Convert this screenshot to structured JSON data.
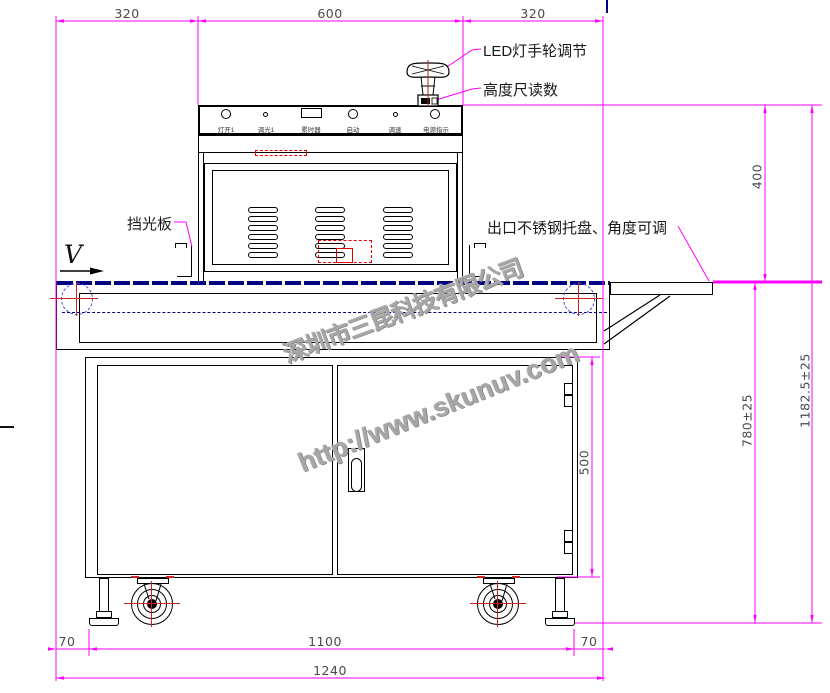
{
  "drawing": {
    "company_watermark": "深圳市三昆科技有限公司",
    "url_watermark": "http://www.skunuv.com",
    "direction_label": "V"
  },
  "callouts": {
    "led_handwheel": "LED灯手轮调节",
    "height_gauge": "高度尺读数",
    "light_shield": "挡光板",
    "outlet_tray": "出口不锈钢托盘、角度可调"
  },
  "control_panel": {
    "items": [
      {
        "label": "灯开1",
        "control": "round-button-large"
      },
      {
        "label": "调光1",
        "control": "round-button-small"
      },
      {
        "label": "累时器",
        "control": "display-window"
      },
      {
        "label": "启动",
        "control": "round-button-large"
      },
      {
        "label": "调速",
        "control": "round-button-small"
      },
      {
        "label": "电源指示",
        "control": "indicator-lamp"
      }
    ]
  },
  "dimensions": {
    "top": [
      "320",
      "600",
      "320"
    ],
    "right": [
      "400",
      "1182.5±25",
      "780±25",
      "500"
    ],
    "bottom": [
      "70",
      "1100",
      "70",
      "1240"
    ]
  },
  "colors": {
    "dimension": "#ff00ff",
    "linework": "#000000",
    "belt": "#000080",
    "centerline_red": "#cc2222",
    "annotation_red": "#ff0000",
    "watermark": "#a6a6a6"
  }
}
